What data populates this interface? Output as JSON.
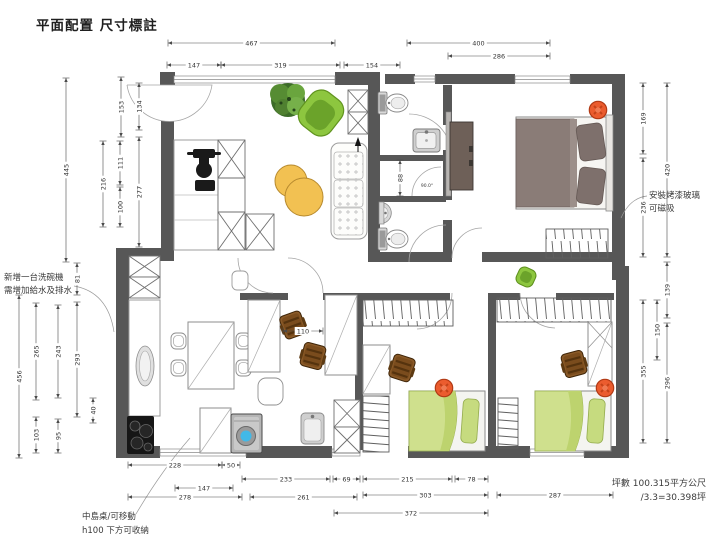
{
  "title": "平面配置 尺寸標註",
  "notes": [
    {
      "name": "note-dishwasher",
      "size": 8.5,
      "anchor": "start",
      "lines": [
        {
          "t": "新增一台洗碗機",
          "x": 4,
          "y": 280
        },
        {
          "t": "需增加給水及排水",
          "x": 4,
          "y": 293
        }
      ]
    },
    {
      "name": "note-glass",
      "size": 8.5,
      "anchor": "start",
      "lines": [
        {
          "t": "安裝烤漆玻璃",
          "x": 649,
          "y": 198
        },
        {
          "t": "可磁吸",
          "x": 649,
          "y": 211
        }
      ]
    },
    {
      "name": "note-island",
      "size": 8.5,
      "anchor": "start",
      "lines": [
        {
          "t": "中島桌/可移動",
          "x": 82,
          "y": 519
        },
        {
          "t": "h100 下方可收納",
          "x": 82,
          "y": 533
        }
      ]
    },
    {
      "name": "note-area",
      "size": 9,
      "anchor": "end",
      "lines": [
        {
          "t": "坪數 100.315平方公尺",
          "x": 706,
          "y": 486
        },
        {
          "t": "/3.3=30.398坪",
          "x": 706,
          "y": 500
        }
      ]
    },
    {
      "name": "note-door-angle",
      "size": 4.5,
      "anchor": "middle",
      "lines": [
        {
          "t": "90.0°",
          "x": 427,
          "y": 187
        }
      ]
    }
  ],
  "dimensions": {
    "horizontal": [
      {
        "v": "467",
        "x1": 168,
        "x2": 335,
        "y": 43
      },
      {
        "v": "400",
        "x1": 407,
        "x2": 550,
        "y": 43
      },
      {
        "v": "286",
        "x1": 448,
        "x2": 550,
        "y": 56
      },
      {
        "v": "147",
        "x1": 167,
        "x2": 221,
        "y": 65
      },
      {
        "v": "319",
        "x1": 221,
        "x2": 340,
        "y": 65
      },
      {
        "v": "154",
        "x1": 344,
        "x2": 400,
        "y": 65
      },
      {
        "v": "110",
        "x1": 283,
        "x2": 323,
        "y": 331
      },
      {
        "v": "228",
        "x1": 128,
        "x2": 222,
        "y": 465
      },
      {
        "v": "50",
        "x1": 222,
        "x2": 240,
        "y": 465
      },
      {
        "v": "233",
        "x1": 242,
        "x2": 330,
        "y": 479
      },
      {
        "v": "69",
        "x1": 333,
        "x2": 360,
        "y": 479
      },
      {
        "v": "215",
        "x1": 363,
        "x2": 452,
        "y": 479
      },
      {
        "v": "78",
        "x1": 455,
        "x2": 488,
        "y": 479
      },
      {
        "v": "147",
        "x1": 175,
        "x2": 233,
        "y": 488
      },
      {
        "v": "278",
        "x1": 128,
        "x2": 242,
        "y": 497
      },
      {
        "v": "261",
        "x1": 250,
        "x2": 357,
        "y": 497
      },
      {
        "v": "303",
        "x1": 363,
        "x2": 488,
        "y": 495
      },
      {
        "v": "287",
        "x1": 497,
        "x2": 613,
        "y": 495
      },
      {
        "v": "372",
        "x1": 334,
        "x2": 488,
        "y": 513
      }
    ],
    "vertical": [
      {
        "v": "445",
        "x": 66,
        "y1": 78,
        "y2": 262
      },
      {
        "v": "153",
        "x": 121,
        "y1": 77,
        "y2": 137
      },
      {
        "v": "134",
        "x": 139,
        "y1": 83,
        "y2": 130
      },
      {
        "v": "216",
        "x": 103,
        "y1": 141,
        "y2": 227
      },
      {
        "v": "111",
        "x": 120,
        "y1": 141,
        "y2": 185
      },
      {
        "v": "100",
        "x": 120,
        "y1": 187,
        "y2": 227
      },
      {
        "v": "277",
        "x": 139,
        "y1": 137,
        "y2": 247
      },
      {
        "v": "81",
        "x": 77,
        "y1": 263,
        "y2": 295
      },
      {
        "v": "456",
        "x": 19,
        "y1": 295,
        "y2": 458
      },
      {
        "v": "265",
        "x": 36,
        "y1": 303,
        "y2": 400
      },
      {
        "v": "243",
        "x": 58,
        "y1": 305,
        "y2": 398
      },
      {
        "v": "293",
        "x": 77,
        "y1": 302,
        "y2": 417
      },
      {
        "v": "40",
        "x": 93,
        "y1": 398,
        "y2": 423
      },
      {
        "v": "103",
        "x": 36,
        "y1": 417,
        "y2": 453
      },
      {
        "v": "95",
        "x": 58,
        "y1": 419,
        "y2": 453
      },
      {
        "v": "88",
        "x": 400,
        "y1": 160,
        "y2": 196
      },
      {
        "v": "169",
        "x": 643,
        "y1": 83,
        "y2": 154
      },
      {
        "v": "420",
        "x": 667,
        "y1": 83,
        "y2": 257
      },
      {
        "v": "236",
        "x": 643,
        "y1": 158,
        "y2": 257
      },
      {
        "v": "139",
        "x": 667,
        "y1": 262,
        "y2": 318
      },
      {
        "v": "150",
        "x": 657,
        "y1": 300,
        "y2": 360
      },
      {
        "v": "355",
        "x": 643,
        "y1": 300,
        "y2": 443
      },
      {
        "v": "296",
        "x": 667,
        "y1": 323,
        "y2": 443
      }
    ]
  },
  "colors": {
    "wall": "#575757",
    "dim_line": "#4a4a4a",
    "window": "#8a8a8a",
    "bed_green": "#cfe08d",
    "bed_master": "#8a7c77",
    "chair_green": "#8dc63f",
    "pouf_yellow": "#f2c152",
    "stool_red": "#eb5c2e",
    "chair_wood": "#8a5a28",
    "cabinet_tv": "#6e6058",
    "washer_blue": "#41b9e8"
  }
}
